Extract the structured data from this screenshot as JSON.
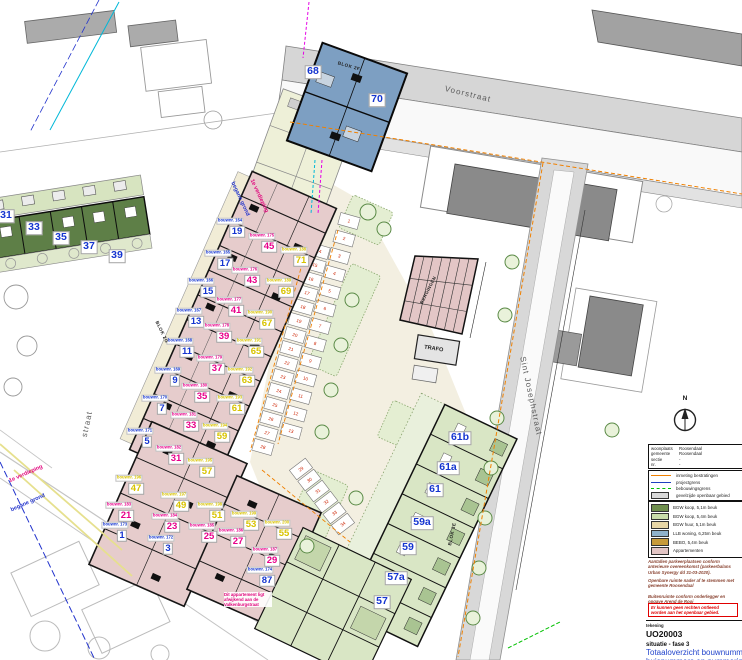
{
  "sheet": {
    "tekening_label": "tekening",
    "drawing_number": "UO20003",
    "phase": "situatie - fase 3",
    "title_line1": "Totaaloverzicht bouwnummers,",
    "title_line2": "huisnummers en nummering",
    "north_label": "N"
  },
  "kadaster_rows": [
    {
      "label": "woonplaats",
      "value": "Roosendaal"
    },
    {
      "label": "gemeente",
      "value": "Roosendaal"
    },
    {
      "label": "sectie",
      "value": "-"
    },
    {
      "label": "nr.",
      "value": "-"
    }
  ],
  "legend_lines": [
    {
      "symbol": "line",
      "color": "#f08000",
      "dashed": false,
      "label": "inmeting bestratingen"
    },
    {
      "symbol": "line",
      "color": "#2040c0",
      "dashed": false,
      "label": "projectgrens"
    },
    {
      "symbol": "line",
      "color": "#00c000",
      "dashed": true,
      "label": "bebouwingsgrens"
    },
    {
      "symbol": "box",
      "color": "#d8d8d8",
      "dashed": false,
      "label": "gevelzijde openbaar gebied"
    }
  ],
  "legend_swatches": [
    {
      "color": "#6f8f4e",
      "label": "BGW koop, 5,1m beuk"
    },
    {
      "color": "#c9dcab",
      "label": "BGW koop, 5,4m beuk"
    },
    {
      "color": "#e8d7a6",
      "label": "BGW huur, 5,1m beuk"
    },
    {
      "color": "#8fb2cc",
      "label": "LLB woning, 6,25m beuk"
    },
    {
      "color": "#c79b3b",
      "label": "BEBO, 5,4m beuk"
    },
    {
      "color": "#e3c6c6",
      "label": "Appartementen"
    }
  ],
  "notes": {
    "para1": "Aantallen parkeerplaatsen conform anterieure overeenkomst (parkeerbalans Urban Synergy dd 31-03-2020).",
    "para2": "Openbare ruimte nader af te stemmen met gemeente Roosendaal",
    "para3": "Buitenruimte conform onderlegger en opgave Arend de Rooi",
    "warning": "Er kunnen geen rechten ontleend worden aan het openbaar gebied."
  },
  "streets": [
    {
      "name": "Voorstraat",
      "x": 468,
      "y": 94,
      "rot": 13.5
    },
    {
      "name": "Sint Josephstraat",
      "x": 531,
      "y": 396,
      "rot": 78
    },
    {
      "name": "straat",
      "x": 87,
      "y": 424,
      "rot": -78
    }
  ],
  "blok_labels": [
    {
      "text": "BLOK 2F",
      "x": 349,
      "y": 66,
      "rot": 16
    },
    {
      "text": "BLOK 2G",
      "x": 162,
      "y": 332,
      "rot": 64
    },
    {
      "text": "BLOK 3E",
      "x": 452,
      "y": 534,
      "rot": -78
    }
  ],
  "floor_labels": [
    {
      "text": "begane grond",
      "color": "#2233cc",
      "x": 240,
      "y": 199,
      "rot": 65
    },
    {
      "text": "1e verdieping",
      "color": "#e0007a",
      "x": 259,
      "y": 196,
      "rot": 65
    },
    {
      "text": "1e verdieping",
      "color": "#e0007a",
      "x": 26,
      "y": 474,
      "rot": -24
    },
    {
      "text": "begane grond",
      "color": "#2233cc",
      "x": 28,
      "y": 503,
      "rot": -24
    }
  ],
  "annotation": {
    "text": "Dit appartement ligt afwijkend aan de Valkenburgstraat",
    "x": 224,
    "y": 592,
    "color": "#e0007a"
  },
  "area_labels": {
    "trafo": "TRAFO",
    "bergingen": "BERGINGEN"
  },
  "bouwnr_prefix": "bouwnr.",
  "floor_colors": {
    "bg": "#1535d0",
    "v1": "#e8008a",
    "v2": "#d8c300"
  },
  "units": [
    {
      "n": "19",
      "floor": "bg",
      "x": 237,
      "y": 232,
      "bouwnr": 164
    },
    {
      "n": "17",
      "floor": "bg",
      "x": 225,
      "y": 264,
      "bouwnr": 165
    },
    {
      "n": "15",
      "floor": "bg",
      "x": 208,
      "y": 292,
      "bouwnr": 166
    },
    {
      "n": "13",
      "floor": "bg",
      "x": 196,
      "y": 322,
      "bouwnr": 167
    },
    {
      "n": "11",
      "floor": "bg",
      "x": 187,
      "y": 352,
      "bouwnr": 168
    },
    {
      "n": "9",
      "floor": "bg",
      "x": 175,
      "y": 381,
      "bouwnr": 169
    },
    {
      "n": "7",
      "floor": "bg",
      "x": 162,
      "y": 409,
      "bouwnr": 170
    },
    {
      "n": "5",
      "floor": "bg",
      "x": 147,
      "y": 442,
      "bouwnr": 171
    },
    {
      "n": "3",
      "floor": "bg",
      "x": 168,
      "y": 549,
      "bouwnr": 172
    },
    {
      "n": "1",
      "floor": "bg",
      "x": 122,
      "y": 536,
      "bouwnr": 173
    },
    {
      "n": "87",
      "floor": "bg",
      "x": 267,
      "y": 581,
      "bouwnr": 174
    },
    {
      "n": "45",
      "floor": "v1",
      "x": 269,
      "y": 247,
      "bouwnr": 175
    },
    {
      "n": "43",
      "floor": "v1",
      "x": 252,
      "y": 281,
      "bouwnr": 176
    },
    {
      "n": "41",
      "floor": "v1",
      "x": 236,
      "y": 311,
      "bouwnr": 177
    },
    {
      "n": "39",
      "floor": "v1",
      "x": 224,
      "y": 337,
      "bouwnr": 178
    },
    {
      "n": "37",
      "floor": "v1",
      "x": 217,
      "y": 369,
      "bouwnr": 179
    },
    {
      "n": "35",
      "floor": "v1",
      "x": 202,
      "y": 397,
      "bouwnr": 180
    },
    {
      "n": "33",
      "floor": "v1",
      "x": 191,
      "y": 426,
      "bouwnr": 181
    },
    {
      "n": "31",
      "floor": "v1",
      "x": 176,
      "y": 459,
      "bouwnr": 182
    },
    {
      "n": "21",
      "floor": "v1",
      "x": 126,
      "y": 516,
      "bouwnr": 183
    },
    {
      "n": "23",
      "floor": "v1",
      "x": 172,
      "y": 527,
      "bouwnr": 184
    },
    {
      "n": "25",
      "floor": "v1",
      "x": 209,
      "y": 537,
      "bouwnr": 185
    },
    {
      "n": "27",
      "floor": "v1",
      "x": 238,
      "y": 542,
      "bouwnr": 186
    },
    {
      "n": "29",
      "floor": "v1",
      "x": 272,
      "y": 561,
      "bouwnr": 187
    },
    {
      "n": "71",
      "floor": "v2",
      "x": 301,
      "y": 261,
      "bouwnr": 188
    },
    {
      "n": "69",
      "floor": "v2",
      "x": 286,
      "y": 292,
      "bouwnr": 189
    },
    {
      "n": "67",
      "floor": "v2",
      "x": 267,
      "y": 324,
      "bouwnr": 190
    },
    {
      "n": "65",
      "floor": "v2",
      "x": 256,
      "y": 352,
      "bouwnr": 191
    },
    {
      "n": "63",
      "floor": "v2",
      "x": 247,
      "y": 381,
      "bouwnr": 192
    },
    {
      "n": "61",
      "floor": "v2",
      "x": 237,
      "y": 409,
      "bouwnr": 193
    },
    {
      "n": "59",
      "floor": "v2",
      "x": 222,
      "y": 437,
      "bouwnr": 194
    },
    {
      "n": "57",
      "floor": "v2",
      "x": 207,
      "y": 472,
      "bouwnr": 195
    },
    {
      "n": "47",
      "floor": "v2",
      "x": 136,
      "y": 489,
      "bouwnr": 196
    },
    {
      "n": "49",
      "floor": "v2",
      "x": 181,
      "y": 506,
      "bouwnr": 197
    },
    {
      "n": "51",
      "floor": "v2",
      "x": 217,
      "y": 516,
      "bouwnr": 198
    },
    {
      "n": "53",
      "floor": "v2",
      "x": 251,
      "y": 525,
      "bouwnr": 199
    },
    {
      "n": "55",
      "floor": "v2",
      "x": 284,
      "y": 534,
      "bouwnr": 200
    }
  ],
  "house_numbers": [
    {
      "n": "31",
      "x": 6,
      "y": 216
    },
    {
      "n": "33",
      "x": 34,
      "y": 228
    },
    {
      "n": "35",
      "x": 61,
      "y": 238
    },
    {
      "n": "37",
      "x": 89,
      "y": 247
    },
    {
      "n": "39",
      "x": 117,
      "y": 256
    },
    {
      "n": "68",
      "x": 313,
      "y": 72
    },
    {
      "n": "70",
      "x": 377,
      "y": 100
    },
    {
      "n": "61b",
      "x": 460,
      "y": 438
    },
    {
      "n": "61a",
      "x": 448,
      "y": 468
    },
    {
      "n": "61",
      "x": 435,
      "y": 490
    },
    {
      "n": "59a",
      "x": 422,
      "y": 523
    },
    {
      "n": "59",
      "x": 408,
      "y": 548
    },
    {
      "n": "57a",
      "x": 396,
      "y": 578
    },
    {
      "n": "57",
      "x": 382,
      "y": 602
    }
  ],
  "parking": {
    "number_color": "#cc2200",
    "strips": [
      {
        "x1": 349,
        "y1": 221,
        "x2": 291,
        "y2": 431,
        "from": 1,
        "to": 13
      },
      {
        "x1": 319,
        "y1": 251,
        "x2": 263,
        "y2": 447,
        "from": 14,
        "to": 28
      },
      {
        "x1": 301,
        "y1": 469,
        "x2": 343,
        "y2": 524,
        "from": 29,
        "to": 34
      }
    ]
  }
}
